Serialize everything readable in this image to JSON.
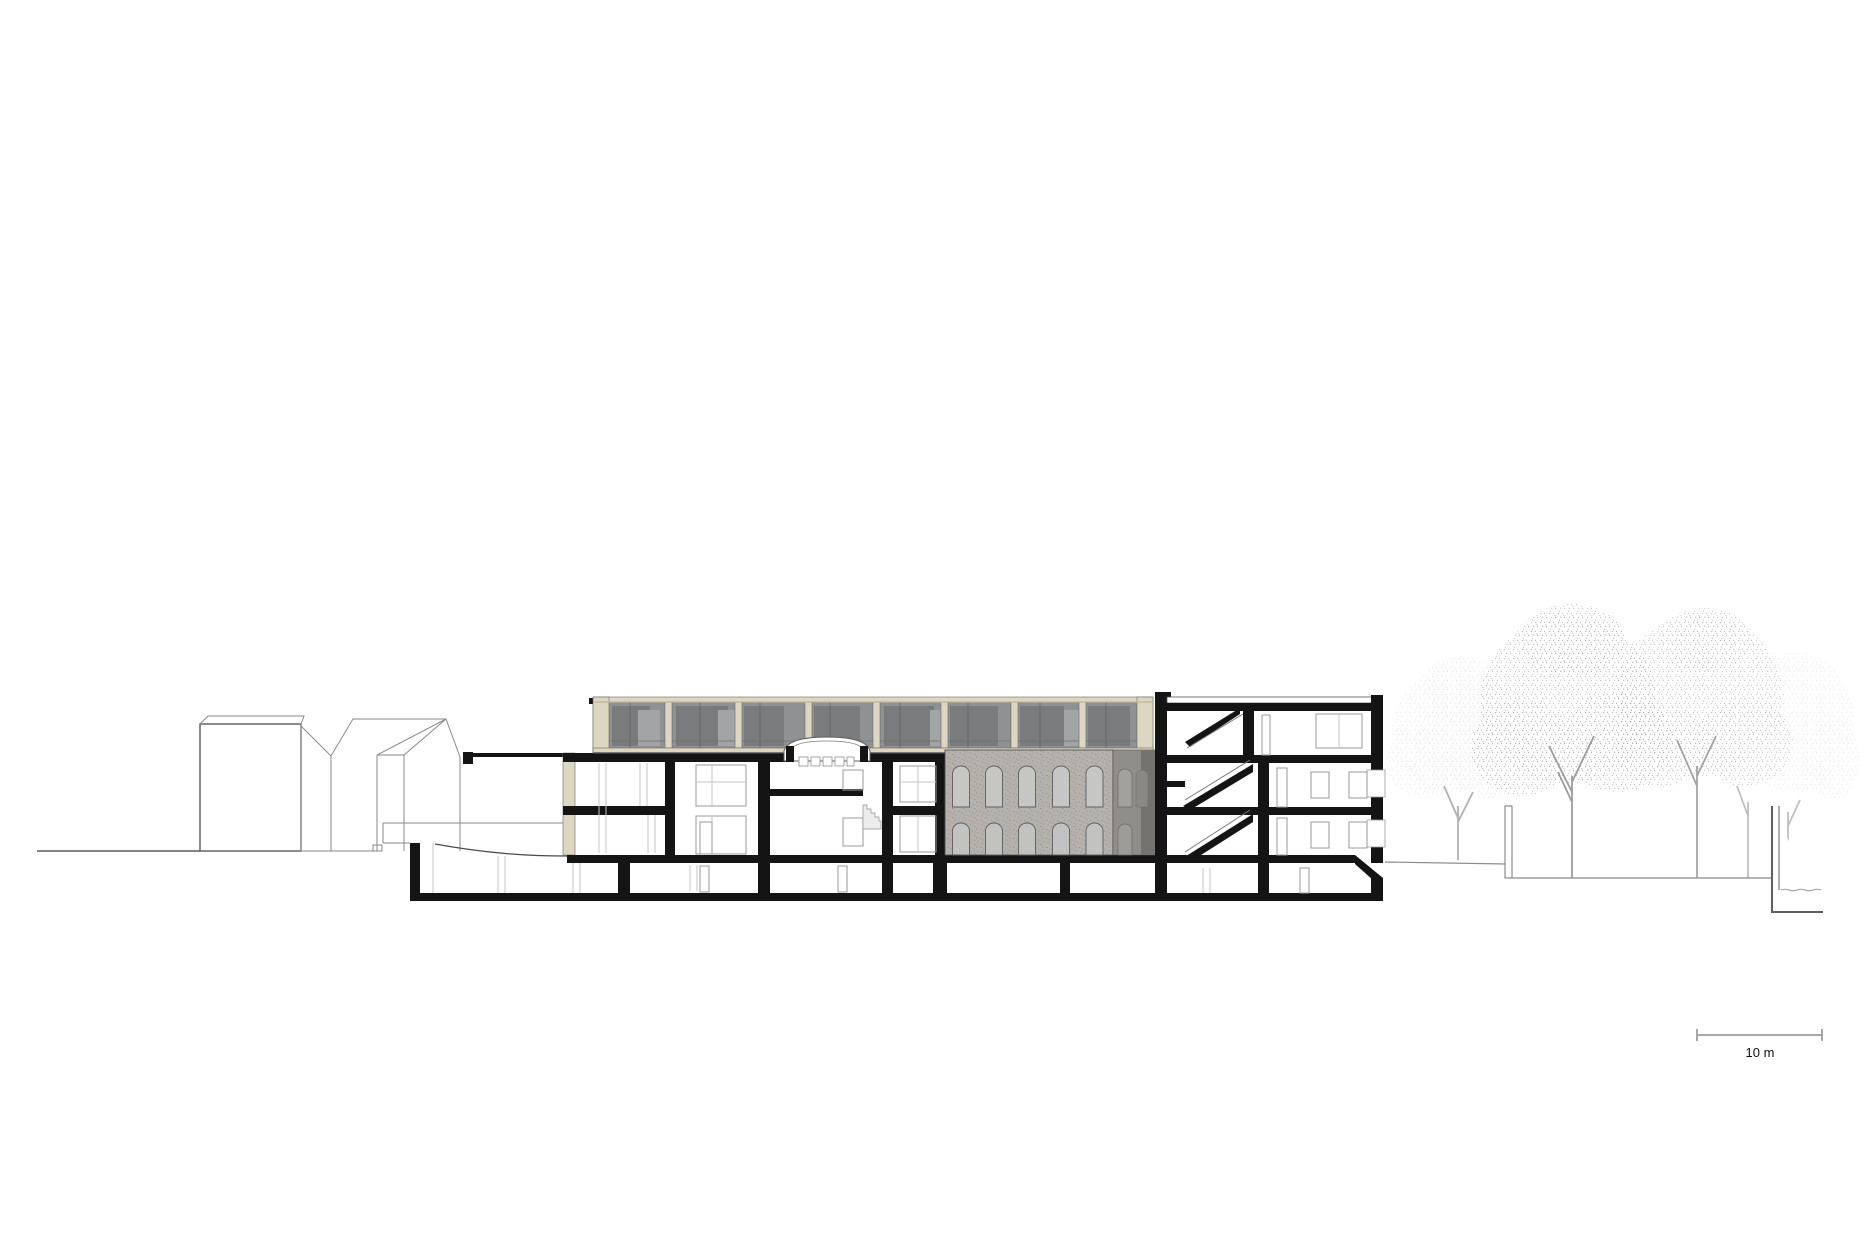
{
  "scale_bar": {
    "label": "10 m"
  },
  "palette": {
    "ink": "#141414",
    "paper": "#ffffff",
    "beige": "#ddd6c1",
    "beige_dark": "#bfb59a",
    "glass": "#8f9193",
    "glass_dark": "#797b7d",
    "glass_light": "#a2a4a5",
    "stone": "#b5b2ad",
    "stone_dark": "#757370",
    "line": "#8a8a8a",
    "line_light": "#c6c6c6",
    "tree": "#9a9a9a"
  }
}
